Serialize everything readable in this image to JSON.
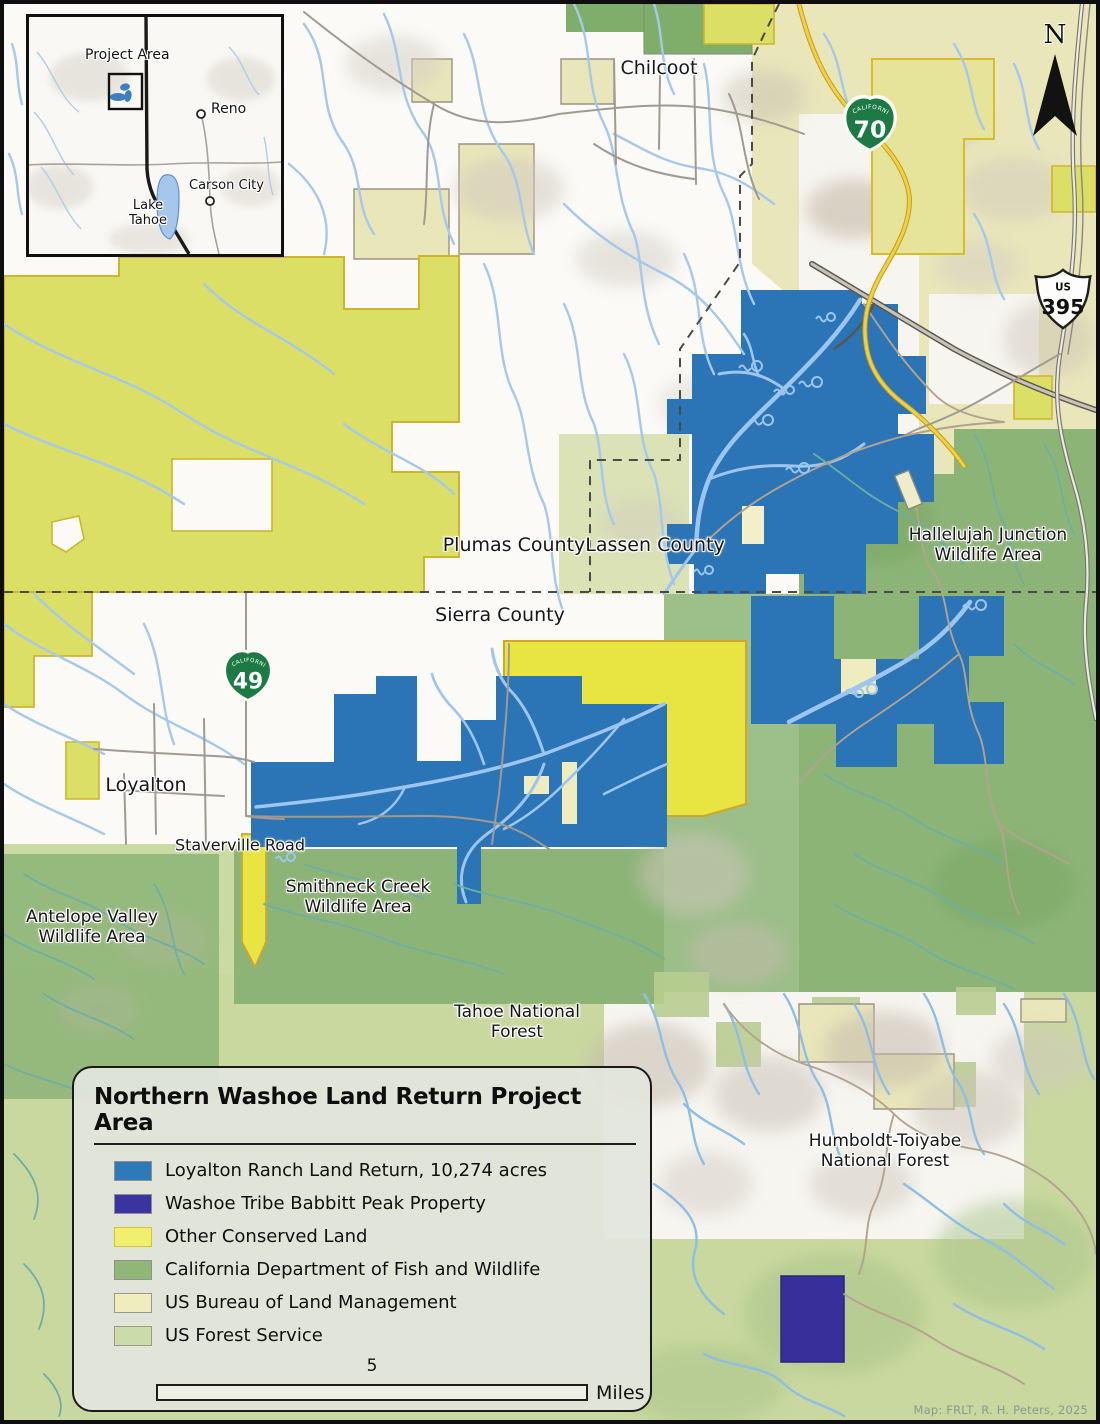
{
  "legend": {
    "title": "Northern Washoe Land Return Project Area",
    "items": [
      {
        "label": "Loyalton Ranch Land Return, 10,274 acres",
        "color": "#2E79B7",
        "border": "#8F8F8F"
      },
      {
        "label": "Washoe Tribe Babbitt Peak Property",
        "color": "#3A34A0",
        "border": "#8F8F8F"
      },
      {
        "label": "Other Conserved Land",
        "color": "#F2EF6E",
        "border": "#D2C62E"
      },
      {
        "label": "California Department of Fish and Wildlife",
        "color": "#8FB878",
        "border": "#8F8F8F"
      },
      {
        "label": "US Bureau of Land Management",
        "color": "#EFEDBE",
        "border": "#9A9A8C"
      },
      {
        "label": "US Forest Service",
        "color": "#CBDCA8",
        "border": "#9A9A8C"
      }
    ],
    "scale": {
      "value": "5",
      "unit": "Miles"
    }
  },
  "north_arrow": {
    "label": "N"
  },
  "credit": "Map: FRLT, R. H. Peters, 2025",
  "inset": {
    "project_area_label": "Project Area",
    "cities": [
      {
        "name": "Reno"
      },
      {
        "name": "Carson City"
      }
    ],
    "lake": {
      "line1": "Lake",
      "line2": "Tahoe"
    }
  },
  "shields": {
    "ca70": {
      "banner": "CALIFORNIA",
      "number": "70"
    },
    "ca49": {
      "banner": "CALIFORNIA",
      "number": "49"
    },
    "us395": {
      "banner": "US",
      "number": "395"
    }
  },
  "map_labels": {
    "chilcoot": {
      "line1": "Chilcoot"
    },
    "plumas": {
      "line1": "Plumas County"
    },
    "lassen": {
      "line1": "Lassen County"
    },
    "sierra": {
      "line1": "Sierra County"
    },
    "loyalton": {
      "line1": "Loyalton"
    },
    "staverville": {
      "line1": "Staverville Road"
    },
    "smithneck": {
      "line1": "Smithneck Creek",
      "line2": "Wildlife Area"
    },
    "antelope": {
      "line1": "Antelope Valley",
      "line2": "Wildlife Area"
    },
    "hallelujah": {
      "line1": "Hallelujah Junction",
      "line2": "Wildlife Area"
    },
    "tahoe_nf": {
      "line1": "Tahoe National",
      "line2": "Forest"
    },
    "humboldt": {
      "line1": "Humboldt-Toiyabe",
      "line2": "National Forest"
    }
  },
  "colors": {
    "loyalton_blue": "#2B74B5",
    "babbitt_purple": "#37309B",
    "conserved_yellow": "#DCDF66",
    "bright_yellow": "#E8E442",
    "cdfw_green": "#8CB477",
    "blm_tan": "#E9E6BA",
    "usfs_green": "#C9D89F",
    "stream_blue": "#A4C9EC",
    "teal_stream": "#6FAEA4",
    "highway_yellow": "#EFD03C",
    "shield_green": "#1D7A45"
  }
}
